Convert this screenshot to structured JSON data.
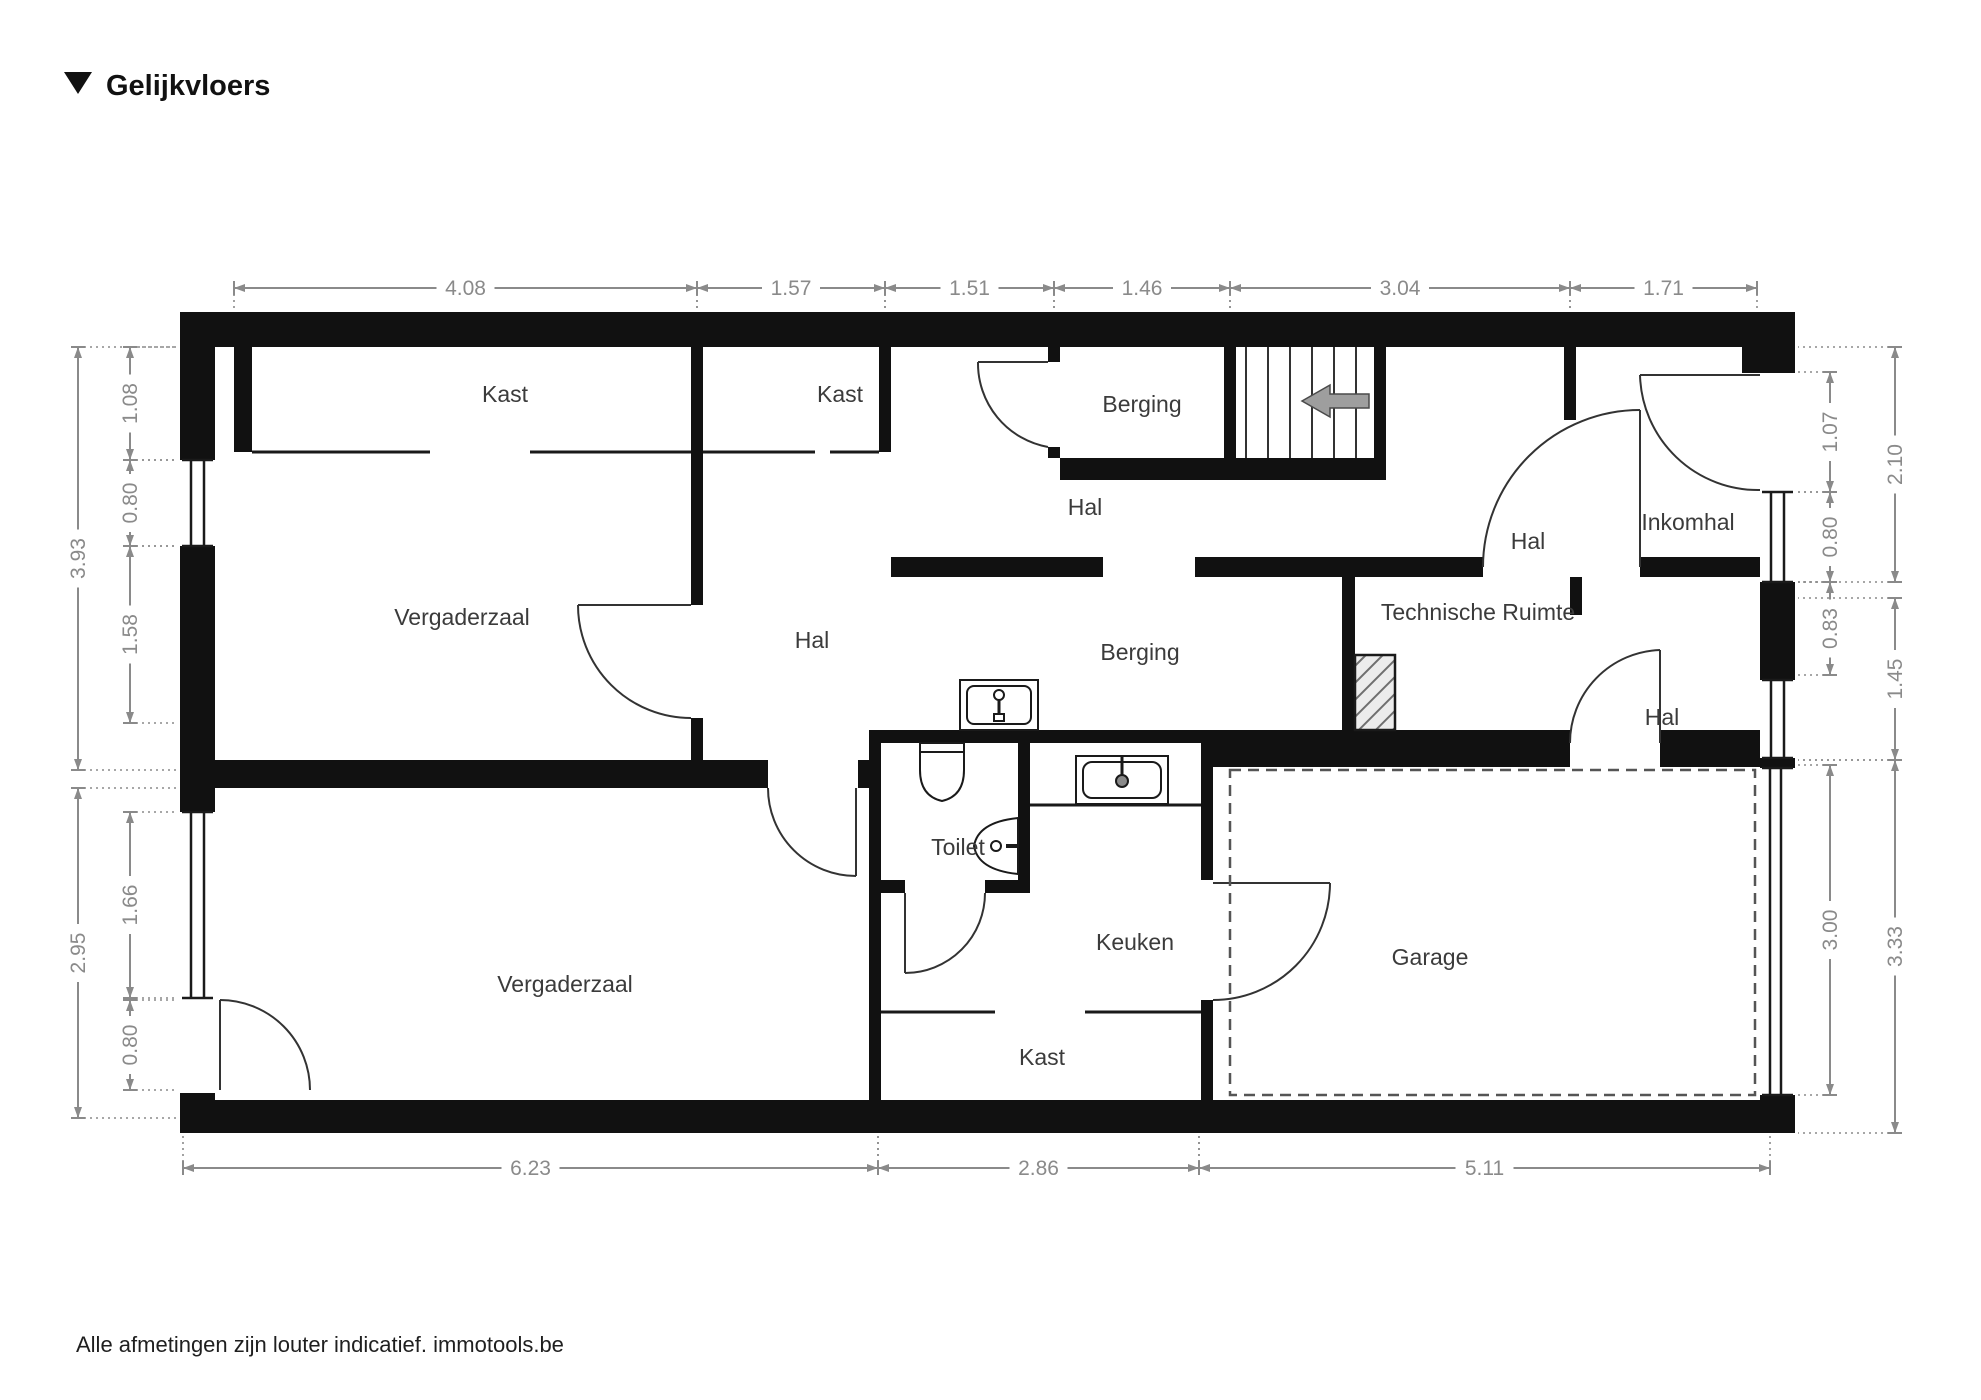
{
  "title": {
    "text": "Gelijkvloers"
  },
  "footer": {
    "text": "Alle afmetingen zijn louter indicatief. immotools.be"
  },
  "colors": {
    "wall": "#111111",
    "thin_line": "#1a1a1a",
    "dimension": "#8a8a8a",
    "label": "#3b3b3b",
    "stairs_arrow": "#9e9e9e",
    "dashed_outline": "#555555"
  },
  "rooms": [
    {
      "label": "Kast",
      "x": 505,
      "y": 402
    },
    {
      "label": "Kast",
      "x": 840,
      "y": 402
    },
    {
      "label": "Berging",
      "x": 1142,
      "y": 412
    },
    {
      "label": "Hal",
      "x": 1085,
      "y": 515
    },
    {
      "label": "Hal",
      "x": 1528,
      "y": 549
    },
    {
      "label": "Inkomhal",
      "x": 1688,
      "y": 530
    },
    {
      "label": "Vergaderzaal",
      "x": 462,
      "y": 625
    },
    {
      "label": "Hal",
      "x": 812,
      "y": 648
    },
    {
      "label": "Berging",
      "x": 1140,
      "y": 660
    },
    {
      "label": "Technische Ruimte",
      "x": 1478,
      "y": 620
    },
    {
      "label": "Hal",
      "x": 1662,
      "y": 725
    },
    {
      "label": "Toilet",
      "x": 958,
      "y": 855
    },
    {
      "label": "Keuken",
      "x": 1135,
      "y": 950
    },
    {
      "label": "Garage",
      "x": 1430,
      "y": 965
    },
    {
      "label": "Vergaderzaal",
      "x": 565,
      "y": 992
    },
    {
      "label": "Kast",
      "x": 1042,
      "y": 1065
    }
  ],
  "dimensions": {
    "top": [
      {
        "v": "4.08",
        "a": 234,
        "b": 697
      },
      {
        "v": "1.57",
        "a": 697,
        "b": 885
      },
      {
        "v": "1.51",
        "a": 885,
        "b": 1054
      },
      {
        "v": "1.46",
        "a": 1054,
        "b": 1230
      },
      {
        "v": "3.04",
        "a": 1230,
        "b": 1570
      },
      {
        "v": "1.71",
        "a": 1570,
        "b": 1757
      }
    ],
    "bottom": [
      {
        "v": "6.23",
        "a": 183,
        "b": 878
      },
      {
        "v": "2.86",
        "a": 878,
        "b": 1199
      },
      {
        "v": "5.11",
        "a": 1199,
        "b": 1770
      }
    ],
    "left_inner": [
      {
        "v": "1.08",
        "a": 347,
        "b": 460
      },
      {
        "v": "0.80",
        "a": 460,
        "b": 546
      },
      {
        "v": "1.58",
        "a": 546,
        "b": 723
      },
      {
        "v": "1.66",
        "a": 812,
        "b": 998
      },
      {
        "v": "0.80",
        "a": 1000,
        "b": 1090
      }
    ],
    "left_outer": [
      {
        "v": "3.93",
        "a": 347,
        "b": 770
      },
      {
        "v": "2.95",
        "a": 788,
        "b": 1118
      }
    ],
    "right_inner": [
      {
        "v": "1.07",
        "a": 372,
        "b": 492
      },
      {
        "v": "0.80",
        "a": 492,
        "b": 582
      },
      {
        "v": "0.83",
        "a": 582,
        "b": 675
      },
      {
        "v": "3.00",
        "a": 765,
        "b": 1095
      }
    ],
    "right_outer": [
      {
        "v": "2.10",
        "a": 347,
        "b": 582
      },
      {
        "v": "1.45",
        "a": 598,
        "b": 760
      },
      {
        "v": "3.33",
        "a": 760,
        "b": 1133
      }
    ]
  }
}
